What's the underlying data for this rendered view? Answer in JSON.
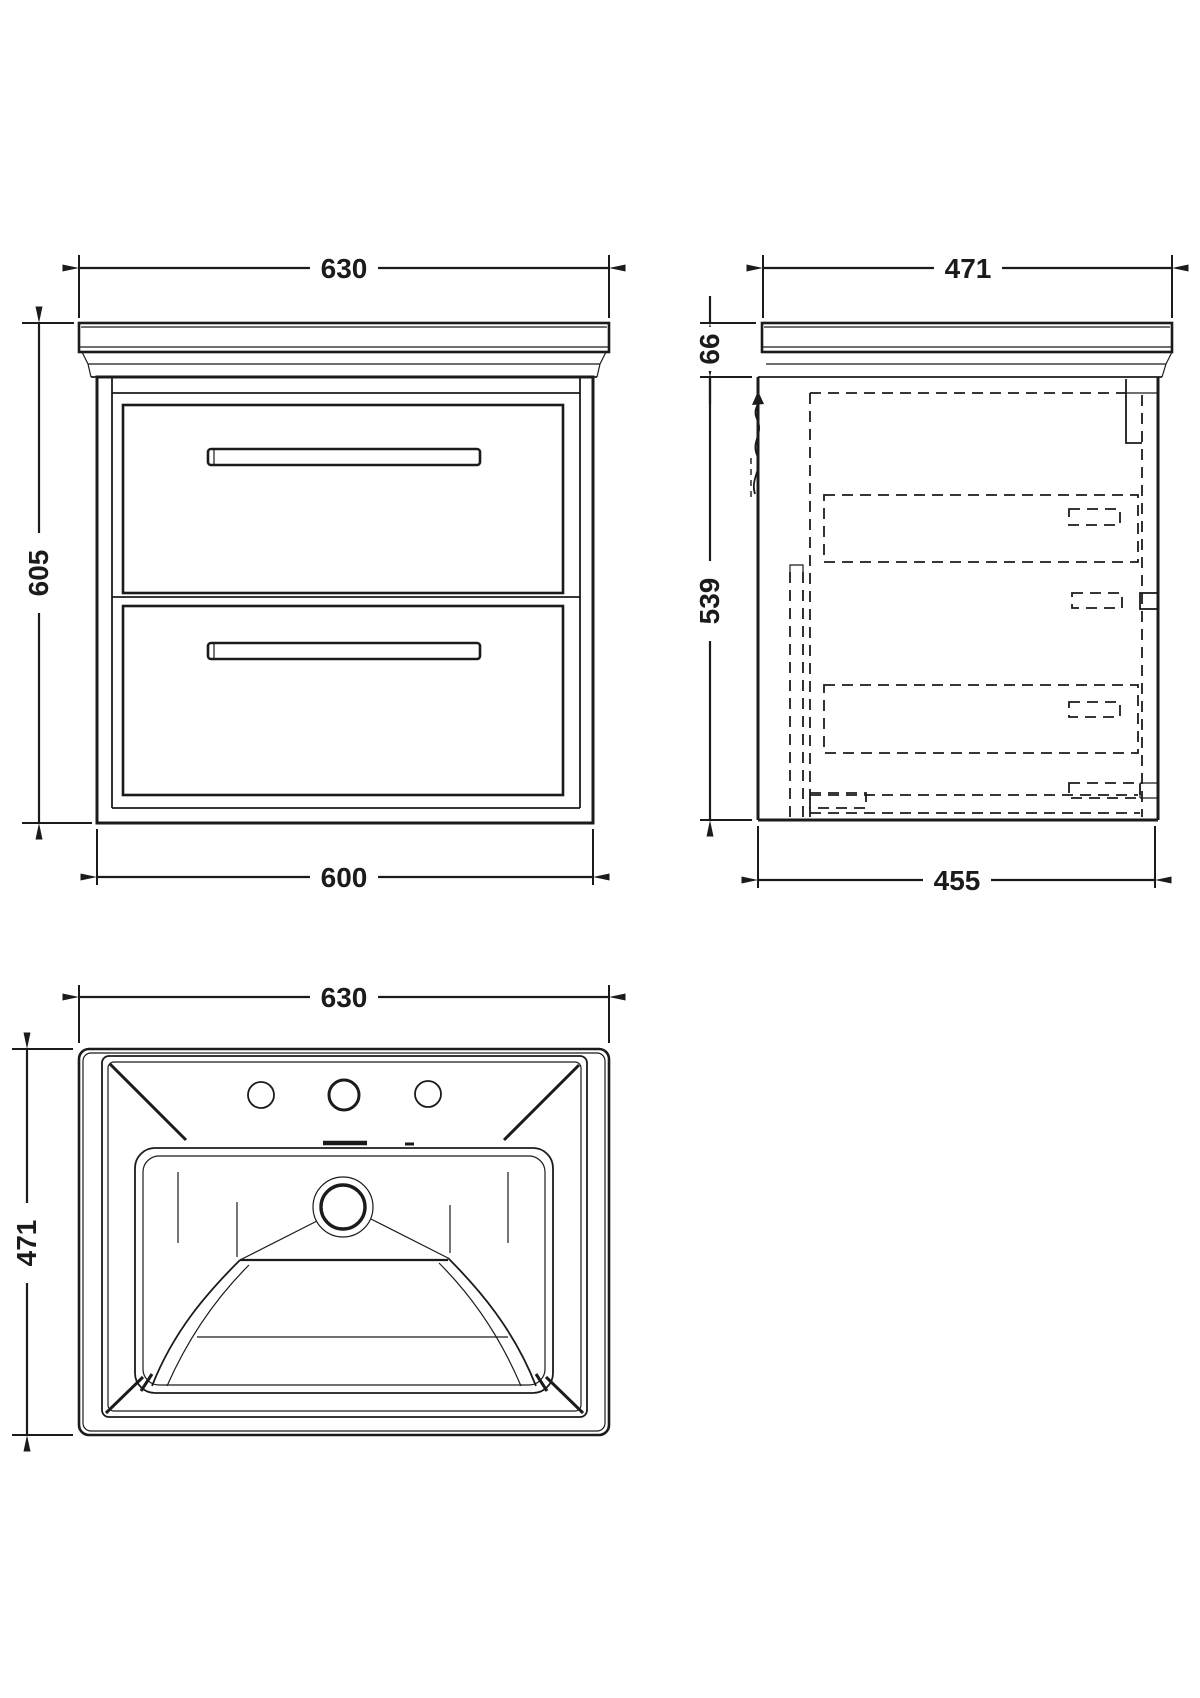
{
  "front": {
    "width_top": "630",
    "height": "605",
    "width_bottom": "600"
  },
  "side": {
    "depth_top": "471",
    "counter_height": "66",
    "body_height": "539",
    "depth_bottom": "455"
  },
  "plan": {
    "width": "630",
    "depth": "471"
  },
  "colors": {
    "line": "#1b1b1b",
    "background": "#ffffff"
  }
}
